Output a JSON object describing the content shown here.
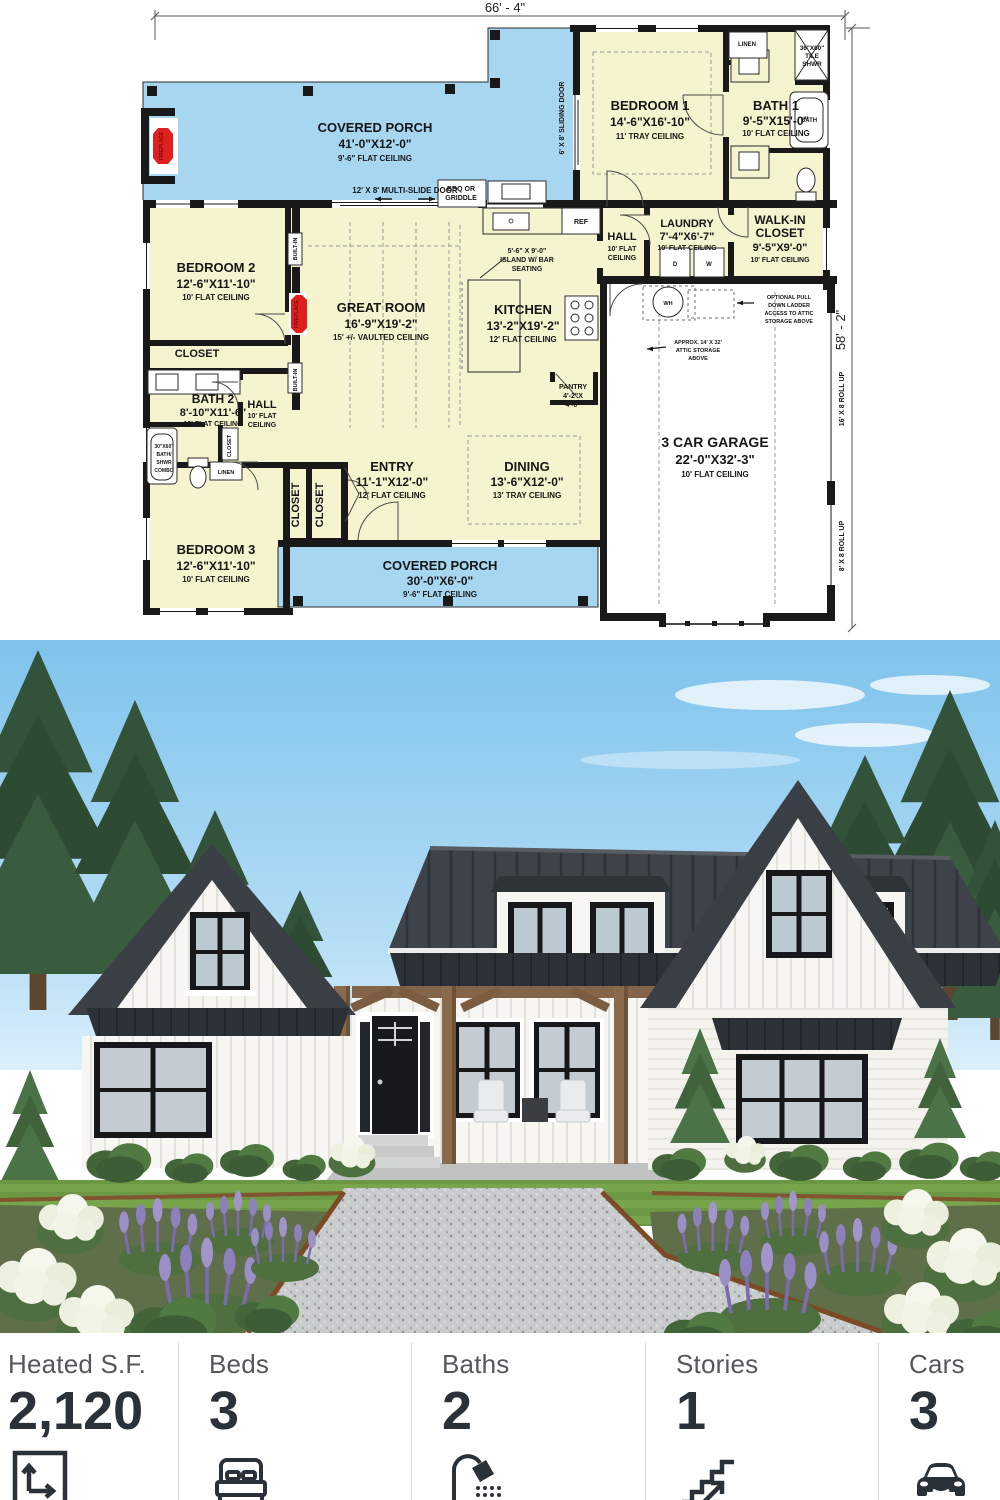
{
  "plan": {
    "dim_top": "66' - 4\"",
    "dim_right": "58' - 2\"",
    "rooms": {
      "porch_top": {
        "name": "COVERED PORCH",
        "dims": "41'-0\"X12'-0\"",
        "ceiling": "9'-6\" FLAT CEILING"
      },
      "bedroom1": {
        "name": "BEDROOM 1",
        "dims": "14'-6\"X16'-10\"",
        "ceiling": "11' TRAY CEILING"
      },
      "bath1": {
        "name": "BATH 1",
        "dims": "9'-5\"X15'-0\"",
        "ceiling": "10' FLAT CEILING"
      },
      "laundry": {
        "name": "LAUNDRY",
        "dims": "7'-4\"X6'-7\"",
        "ceiling": "10' FLAT CEILING"
      },
      "walkin": {
        "name1": "WALK-IN",
        "name2": "CLOSET",
        "dims": "9'-5\"X9'-0\"",
        "ceiling": "10' FLAT CEILING"
      },
      "hall_center": {
        "name": "HALL",
        "ceiling1": "10' FLAT",
        "ceiling2": "CEILING"
      },
      "hall_left": {
        "name": "HALL",
        "ceiling1": "10' FLAT",
        "ceiling2": "CEILING"
      },
      "bedroom2": {
        "name": "BEDROOM 2",
        "dims": "12'-6\"X11'-10\"",
        "ceiling": "10' FLAT CEILING"
      },
      "great_room": {
        "name": "GREAT ROOM",
        "dims": "16'-9\"X19'-2\"",
        "ceiling": "15' +/- VAULTED CEILING"
      },
      "kitchen": {
        "name": "KITCHEN",
        "dims": "13'-2\"X19'-2\"",
        "ceiling": "12' FLAT CEILING"
      },
      "island": {
        "l1": "5'-6\" X 9'-0\"",
        "l2": "ISLAND W/ BAR",
        "l3": "SEATING"
      },
      "closet_bd2": "CLOSET",
      "bath2": {
        "name": "BATH 2",
        "dims": "8'-10\"X11'-6\"",
        "ceiling": "10' FLAT CEILING"
      },
      "bedroom3": {
        "name": "BEDROOM 3",
        "dims": "12'-6\"X11'-10\"",
        "ceiling": "10' FLAT CEILING"
      },
      "entry": {
        "name": "ENTRY",
        "dims": "11'-1\"X12'-0\"",
        "ceiling": "12' FLAT CEILING"
      },
      "dining": {
        "name": "DINING",
        "dims": "13'-6\"X12'-0\"",
        "ceiling": "13' TRAY CEILING"
      },
      "porch_bottom": {
        "name": "COVERED PORCH",
        "dims": "30'-0\"X6'-0\"",
        "ceiling": "9'-6\" FLAT CEILING"
      },
      "garage": {
        "name": "3 CAR GARAGE",
        "dims": "22'-0\"X32'-3\"",
        "ceiling": "10' FLAT CEILING"
      },
      "pantry": {
        "name": "PANTRY",
        "d1": "4'-2\"X",
        "d2": "4'-0\""
      }
    },
    "labels": {
      "ref": "REF",
      "bbq1": "BBQ OR",
      "bbq2": "GRIDDLE",
      "d": "D",
      "w": "W",
      "wh": "WH",
      "linen_top": "LINEN",
      "linen_bath2": "LINEN",
      "tile1": "36\"X60\"",
      "tile2": "TILE",
      "tile3": "SHWR",
      "bath_tub": "BATH",
      "combo1": "30\"X60\"",
      "combo2": "BATH/",
      "combo3": "SHWR",
      "combo4": "COMBO",
      "closet_v": "CLOSET",
      "closet_v2": "CLOSET",
      "closet_small": "CLOSET",
      "built_in1": "BUILT-IN",
      "built_in2": "BUILT-IN",
      "fireplace1": "FIREPLACE",
      "fireplace2": "FIREPLACE",
      "sliding_door": "6' X 8' SLIDING DOOR",
      "multi_slide": "12' X 8' MULTI-SLIDE DOOR",
      "attic_ladder1": "OPTIONAL PULL",
      "attic_ladder2": "DOWN LADDER",
      "attic_ladder3": "ACCESS TO ATTIC",
      "attic_ladder4": "STORAGE ABOVE",
      "attic_storage1": "APPROX. 14' X 32'",
      "attic_storage2": "ATTIC STORAGE",
      "attic_storage3": "ABOVE",
      "roll16": "16' X 8 ROLL UP",
      "roll8": "8' X 8 ROLL UP"
    }
  },
  "photo": {
    "alt": "White modern farmhouse with dark standing-seam metal roof, three gables, wood porch posts, black-framed windows, lavender and white hydrangea beds along a gravel path"
  },
  "stats": [
    {
      "label": "Heated S.F.",
      "value": "2,120"
    },
    {
      "label": "Beds",
      "value": "3"
    },
    {
      "label": "Baths",
      "value": "2"
    },
    {
      "label": "Stories",
      "value": "1"
    },
    {
      "label": "Cars",
      "value": "3"
    }
  ]
}
